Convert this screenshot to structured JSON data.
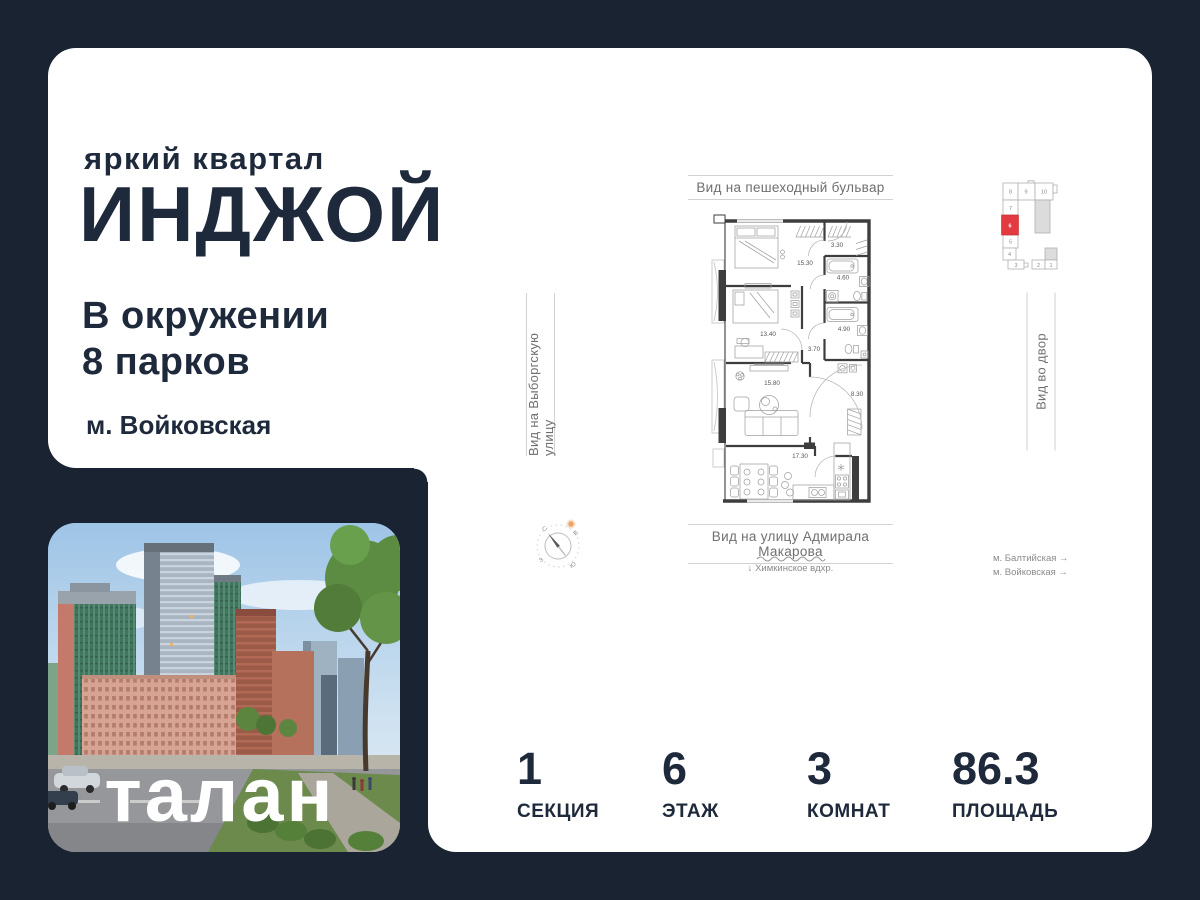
{
  "brand": {
    "tagline": "яркий квартал",
    "name": "ИНДЖОЙ",
    "headline1": "В окружении",
    "headline2": "8 парков",
    "metro": "м. Войковская"
  },
  "developer": {
    "logo": "талан"
  },
  "plan": {
    "title_top": "Вид на пешеходный бульвар",
    "title_bottom": "Вид на улицу Адмирала Макарова",
    "title_left": "Вид на Выборгскую улицу",
    "title_right": "Вид во двор",
    "water_arrow": "↓",
    "water_note": "Химкинское вдхр.",
    "metro_notes": [
      {
        "label": "м. Балтийская →"
      },
      {
        "label": "м. Войковская →"
      }
    ],
    "rooms": {
      "bedroom1": "15.30",
      "entry": "3.30",
      "bath1": "4.60",
      "bedroom2": "13.40",
      "bath2": "4.90",
      "hall": "3.70",
      "living": "15.80",
      "corridor": "8.30",
      "kitchen": "17.30"
    },
    "compass": {
      "north": "С",
      "east": "В",
      "south": "Ю",
      "west": "З"
    }
  },
  "section_key": {
    "highlighted": "6",
    "cells": {
      "c1": "1",
      "c2": "2",
      "c3": "3",
      "c4": "4",
      "c5": "5",
      "c6": "6",
      "c7": "7",
      "c8": "8",
      "c9": "9",
      "c10": "10"
    }
  },
  "stats": [
    {
      "value": "1",
      "label": "СЕКЦИЯ"
    },
    {
      "value": "6",
      "label": "ЭТАЖ"
    },
    {
      "value": "3",
      "label": "КОМНАТ"
    },
    {
      "value": "86.3",
      "label": "ПЛОЩАДЬ"
    }
  ],
  "colors": {
    "background_navy": "#1a2332",
    "ink_navy": "#1e2a3c",
    "card_white": "#ffffff",
    "highlight_red": "#e23a40",
    "compass_orange": "#eda25f",
    "plan_wall": "#3d3d3d"
  }
}
